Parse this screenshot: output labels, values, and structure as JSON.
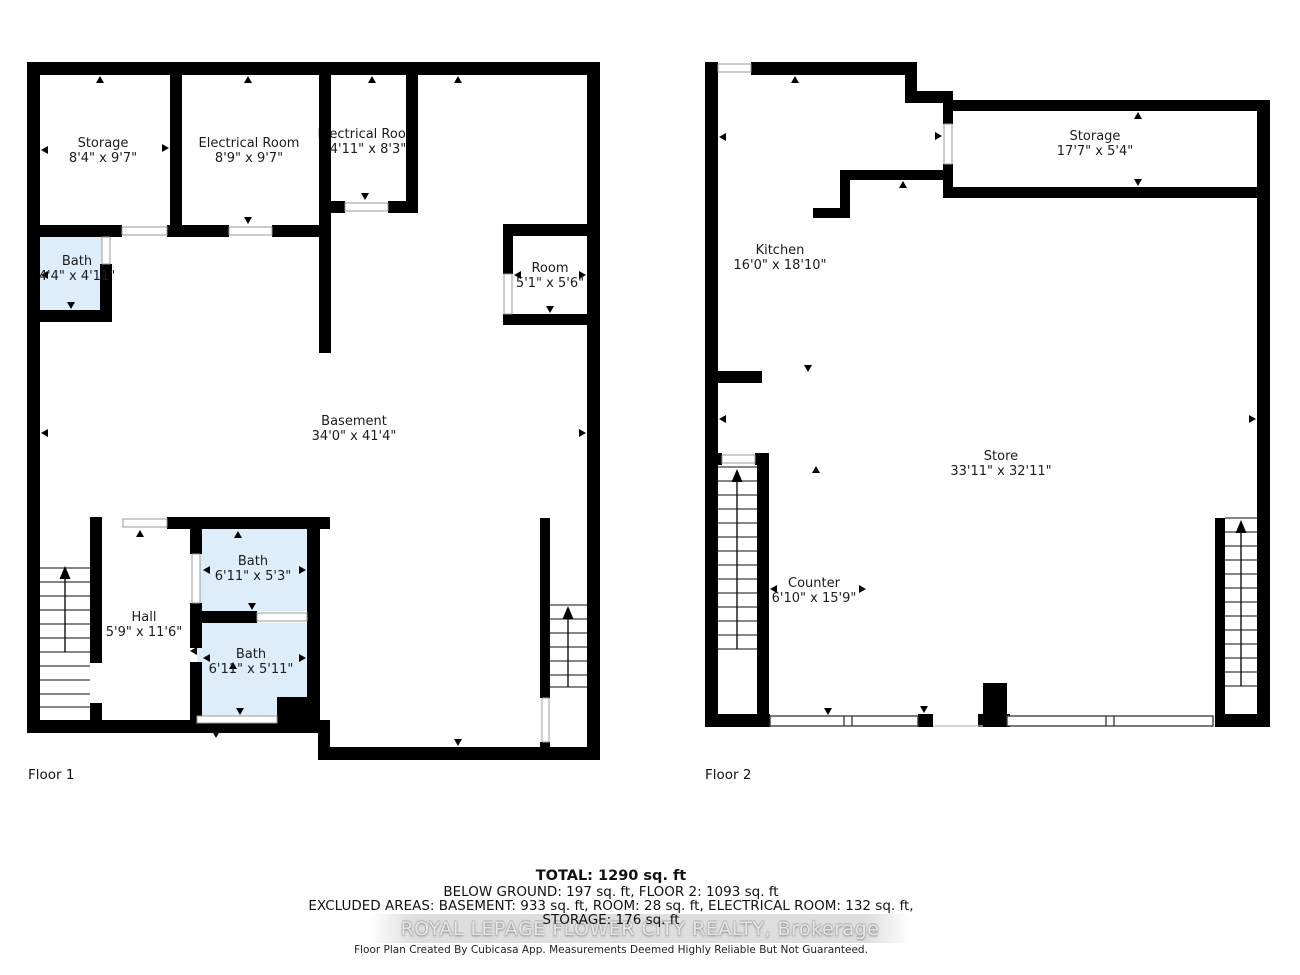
{
  "floor1": {
    "label": "Floor 1",
    "rooms": [
      {
        "name": "Storage",
        "dims": "8'4\" x 9'7\""
      },
      {
        "name": "Electrical Room",
        "dims": "8'9\" x 9'7\""
      },
      {
        "name": "Electrical Room",
        "dims": "4'11\" x 8'3\""
      },
      {
        "name": "Bath",
        "dims": "4'4\" x 4'11\""
      },
      {
        "name": "Room",
        "dims": "5'1\" x 5'6\""
      },
      {
        "name": "Basement",
        "dims": "34'0\" x 41'4\""
      },
      {
        "name": "Hall",
        "dims": "5'9\" x 11'6\""
      },
      {
        "name": "Bath",
        "dims": "6'11\" x 5'3\""
      },
      {
        "name": "Bath",
        "dims": "6'11\" x 5'11\""
      }
    ]
  },
  "floor2": {
    "label": "Floor 2",
    "rooms": [
      {
        "name": "Kitchen",
        "dims": "16'0\" x 18'10\""
      },
      {
        "name": "Storage",
        "dims": "17'7\" x 5'4\""
      },
      {
        "name": "Store",
        "dims": "33'11\" x 32'11\""
      },
      {
        "name": "Counter",
        "dims": "6'10\" x 15'9\""
      }
    ]
  },
  "summary": {
    "total": "TOTAL: 1290 sq. ft",
    "line2": "BELOW GROUND: 197 sq. ft, FLOOR 2: 1093 sq. ft",
    "line3": "EXCLUDED AREAS: BASEMENT: 933 sq. ft, ROOM: 28 sq. ft, ELECTRICAL ROOM: 132 sq. ft,",
    "line4": "STORAGE: 176 sq. ft",
    "watermark": "ROYAL LEPAGE FLOWER CITY REALTY, Brokerage",
    "disclaimer": "Floor Plan Created By Cubicasa App. Measurements Deemed Highly Reliable But Not Guaranteed."
  },
  "icons": {
    "stairs_up_arrow": "▲",
    "door_tick": "▾"
  },
  "colors": {
    "wall": "#000000",
    "bath_fill": "#ddeefa",
    "tread_line": "#3c3c3c",
    "watermark_band": "#d3d3d3"
  }
}
